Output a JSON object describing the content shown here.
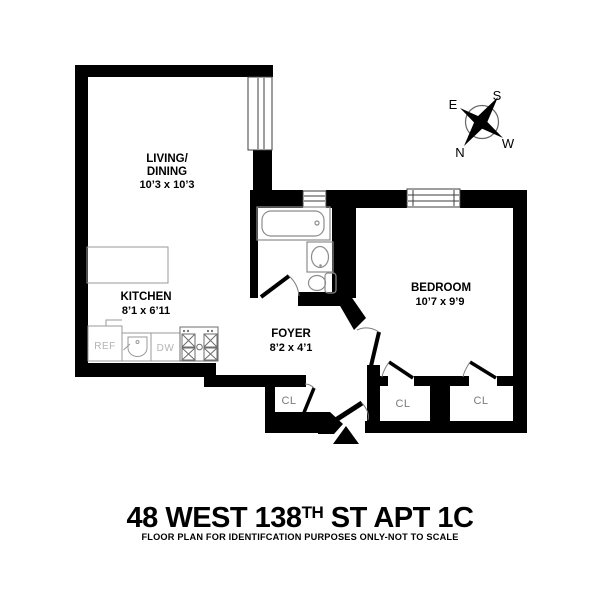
{
  "title": {
    "main_prefix": "48 WEST 138",
    "main_superscript": "TH",
    "main_suffix": " ST APT 1C",
    "subtitle": "FLOOR PLAN FOR IDENTIFCATION PURPOSES ONLY-NOT TO SCALE"
  },
  "compass": {
    "east": "E",
    "south": "S",
    "north": "N",
    "west": "W"
  },
  "rooms": {
    "living_dining": {
      "name_line1": "LIVING/",
      "name_line2": "DINING",
      "dims": "10’3 x 10’3"
    },
    "kitchen": {
      "name": "KITCHEN",
      "dims": "8’1 x 6’11"
    },
    "foyer": {
      "name": "FOYER",
      "dims": "8’2 x 4’1"
    },
    "bedroom": {
      "name": "BEDROOM",
      "dims": "10’7 x 9’9"
    },
    "closets": {
      "foyer_closet": "CL",
      "bedroom_closet_left": "CL",
      "bedroom_closet_right": "CL"
    }
  },
  "kitchen_appliances": {
    "refrigerator": "REF",
    "dishwasher": "DW"
  },
  "colors": {
    "wall": "#000000",
    "background": "#ffffff",
    "fixture_stroke": "#8c8c8c",
    "appliance_label": "#b4b4b4",
    "closet_label": "#7a7a7a",
    "label_text": "#000000"
  }
}
